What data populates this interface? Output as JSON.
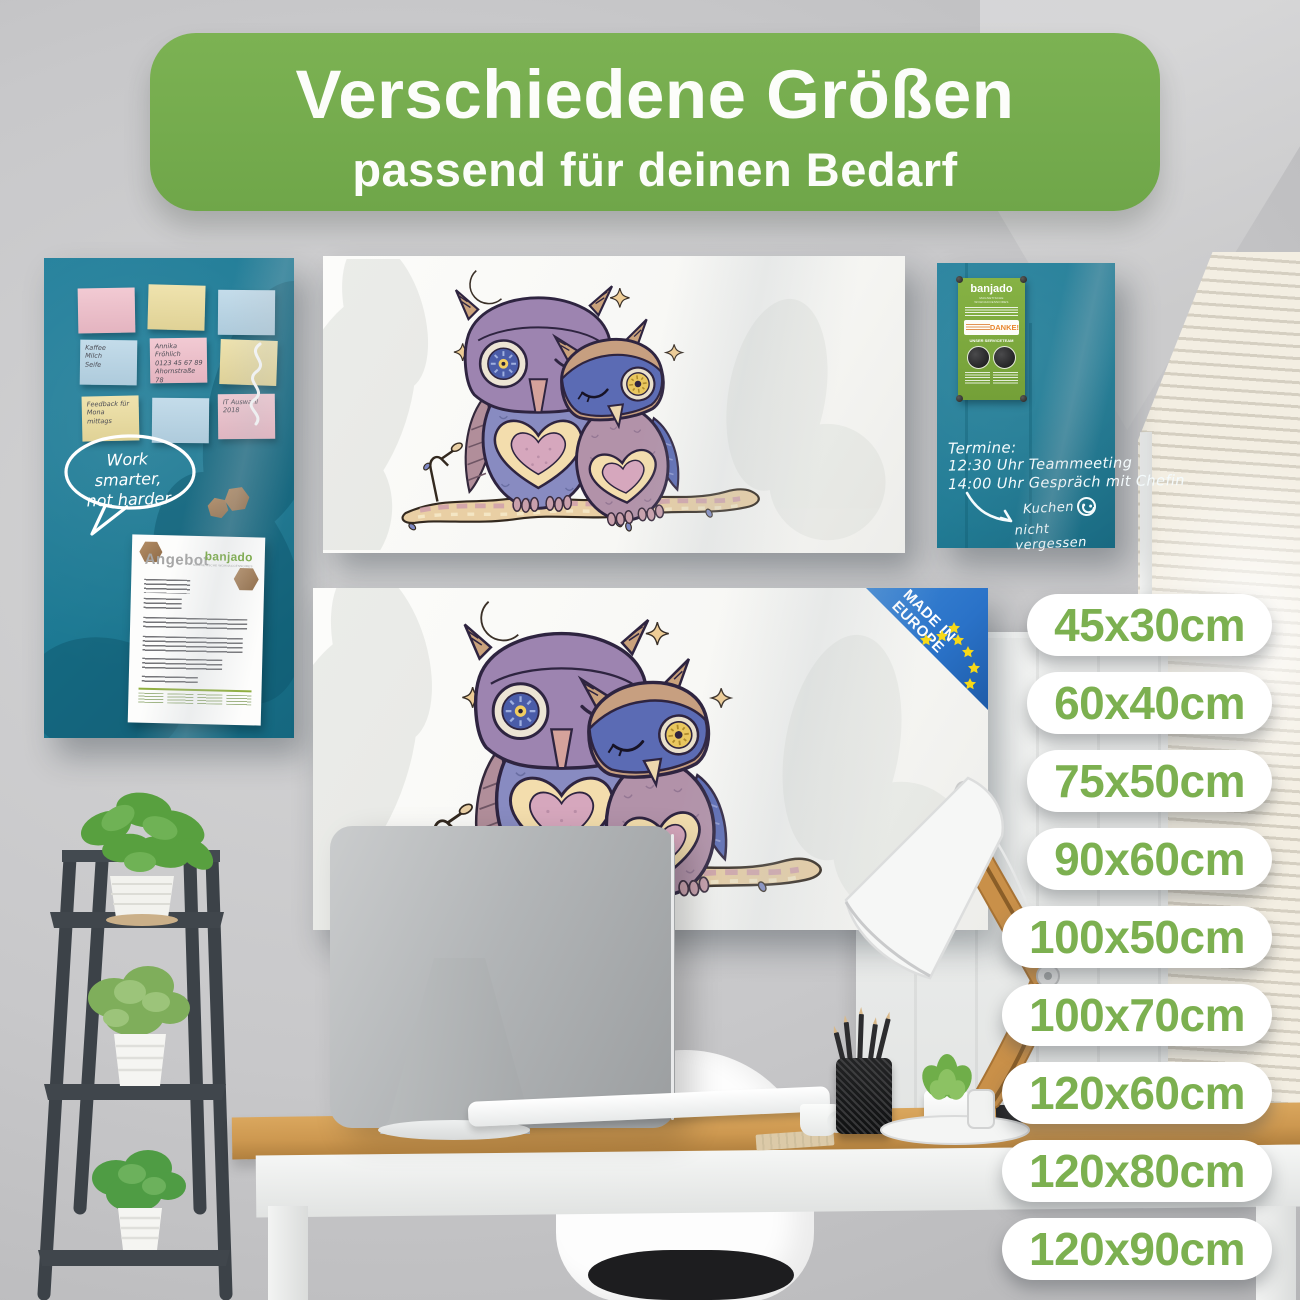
{
  "banner": {
    "title": "Verschiedene Größen",
    "subtitle": "passend für deinen Bedarf"
  },
  "sizes": [
    "45x30cm",
    "60x40cm",
    "75x50cm",
    "90x60cm",
    "100x50cm",
    "100x70cm",
    "120x60cm",
    "120x80cm",
    "120x90cm"
  ],
  "made_in_europe": {
    "line1": "MADE IN",
    "line2": "EUROPE"
  },
  "left_board": {
    "notes": [
      {
        "text": ""
      },
      {
        "text": ""
      },
      {
        "text": ""
      },
      {
        "text": "Kaffee\nMilch\nSeife"
      },
      {
        "text": "Annika Fröhlich\n0123 45 67 89\nAhornstraße 78\n01234 Freiburg"
      },
      {
        "text": ""
      },
      {
        "text": "Feedback für\nMona\nmittags"
      },
      {
        "text": ""
      },
      {
        "text": "IT Auswahl\n2018"
      }
    ],
    "speech_bubble": "Work smarter,\nnot harder",
    "document": {
      "title": "Angebot",
      "brand": "banjado",
      "brand_tagline": "MAGNETISCHE WOHNACCESSOIRES"
    }
  },
  "right_board": {
    "flyer": {
      "brand": "banjado",
      "tagline": "MAGNETISCHE WOHNACCESSOIRES",
      "danke": "DANKE!",
      "team": "UNSER SERVICETEAM"
    },
    "schedule": [
      "Termine:",
      "12:30 Uhr Teammeeting",
      "14:00 Uhr Gespräch mit Chefin"
    ],
    "reminder": [
      "Kuchen",
      "nicht vergessen"
    ]
  },
  "colors": {
    "accent_green": "#76ab4d",
    "pill_text_green": "#7cb050",
    "board_teal": "#1b7892",
    "badge_blue": "#2a72c8",
    "eu_star_yellow": "#f7d917",
    "brand_green": "#76a93e",
    "danke_orange": "#e8852c"
  }
}
